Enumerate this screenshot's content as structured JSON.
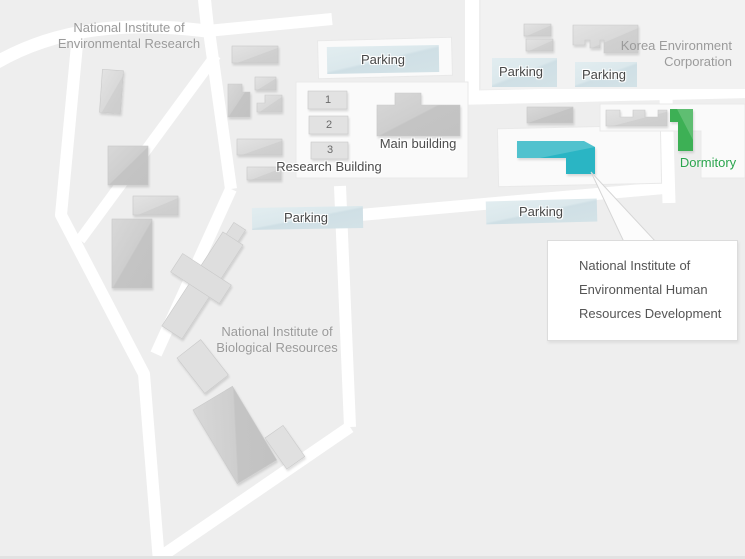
{
  "map": {
    "labels": {
      "nier_line1": "National Institute of",
      "nier_line2": "Environmental Research",
      "kec_line1": "Korea Environment",
      "kec_line2": "Corporation",
      "nibr_line1": "National Institute of",
      "nibr_line2": "Biological Resources",
      "main_building": "Main building",
      "research_building": "Research Building",
      "dormitory": "Dormitory",
      "parking": "Parking"
    },
    "research_units": [
      "1",
      "2",
      "3"
    ],
    "callout": {
      "line1": "National Institute of",
      "line2": "Environmental Human",
      "line3": "Resources Development"
    },
    "colors": {
      "highlight_building": "#2bb5c4",
      "dormitory_building": "#3cb054",
      "dormitory_text": "#2aa44d",
      "parking_area": "#d7e5ea",
      "road": "#ffffff",
      "building": "#d6d6d6",
      "background": "#eeeeee"
    }
  }
}
